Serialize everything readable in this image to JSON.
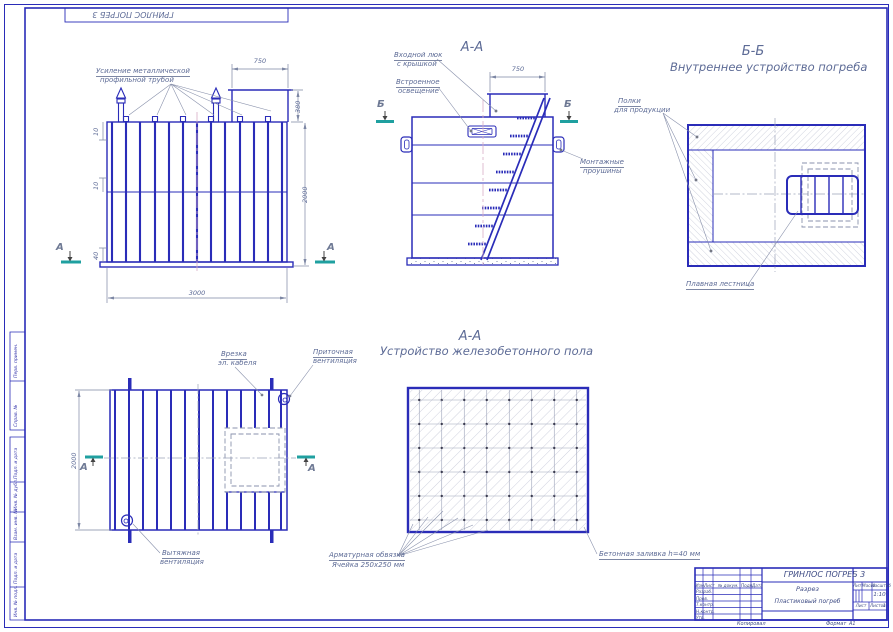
{
  "sheet": {
    "stamp_flipped": "ГРИНЛОС ПОГРЕБ 3",
    "copied": "Копировал",
    "format": "Формат",
    "format_value": "А1",
    "edge": {
      "perv": "Перв. примен.",
      "sprav": "Справ. №",
      "podp1": "Подп. и дата",
      "dubl": "Инв. № дубл.",
      "vzam": "Взам. инв. №",
      "podp2": "Подп. и дата",
      "podl": "Инв. № подл."
    }
  },
  "front": {
    "reinforcement1": "Усиление металлической",
    "reinforcement2": "профильной трубой",
    "dim_750": "750",
    "dim_380": "380",
    "dim_2000": "2000",
    "dim_3000": "3000",
    "dim_10a": "10",
    "dim_10b": "10",
    "dim_40": "40",
    "marker": "А"
  },
  "aa": {
    "title": "А-А",
    "hatch1": "Входной люк",
    "hatch2": "с крышкой",
    "light1": "Встроенное",
    "light2": "освещение",
    "lugs1": "Монтажные",
    "lugs2": "проушины",
    "dim_750": "750",
    "marker": "Б"
  },
  "bb": {
    "title": "Б-Б",
    "subtitle": "Внутреннее устройство погреба",
    "shelves1": "Полки",
    "shelves2": "для продукции",
    "ladder": "Плавная лестница"
  },
  "plan": {
    "cable1": "Врезка",
    "cable2": "эл. кабеля",
    "supply1": "Приточная",
    "supply2": "вентиляция",
    "exhaust1": "Вытяжная",
    "exhaust2": "вентиляция",
    "dim_2000": "2000",
    "marker": "А"
  },
  "floor": {
    "title": "А-А",
    "subtitle": "Устройство железобетонного пола",
    "rebar1": "Арматурная обвязка",
    "rebar2": "Ячейка 250х250 мм",
    "concrete": "Бетонная заливка h=40 мм"
  },
  "titleblock": {
    "name": "ГРИНЛОС ПОГРЕБ 3",
    "doc": "Разрез",
    "subdoc": "Пластиковый погреб",
    "h_izm": "Изм.",
    "h_list": "Лист",
    "h_ndoc": "№ докум.",
    "h_podp": "Подп.",
    "h_data": "Дата",
    "r_razrab": "Разраб.",
    "r_prov": "Пров.",
    "r_tkontr": "Т.контр.",
    "r_nkontr": "Н.контр.",
    "r_utv": "Утв.",
    "h_lit": "Лит.",
    "h_massa": "Масса",
    "h_scale": "Масштаб",
    "scale": "1:10",
    "h_sheet": "Лист",
    "h_sheets": "Листов",
    "sheets_value": "1"
  }
}
